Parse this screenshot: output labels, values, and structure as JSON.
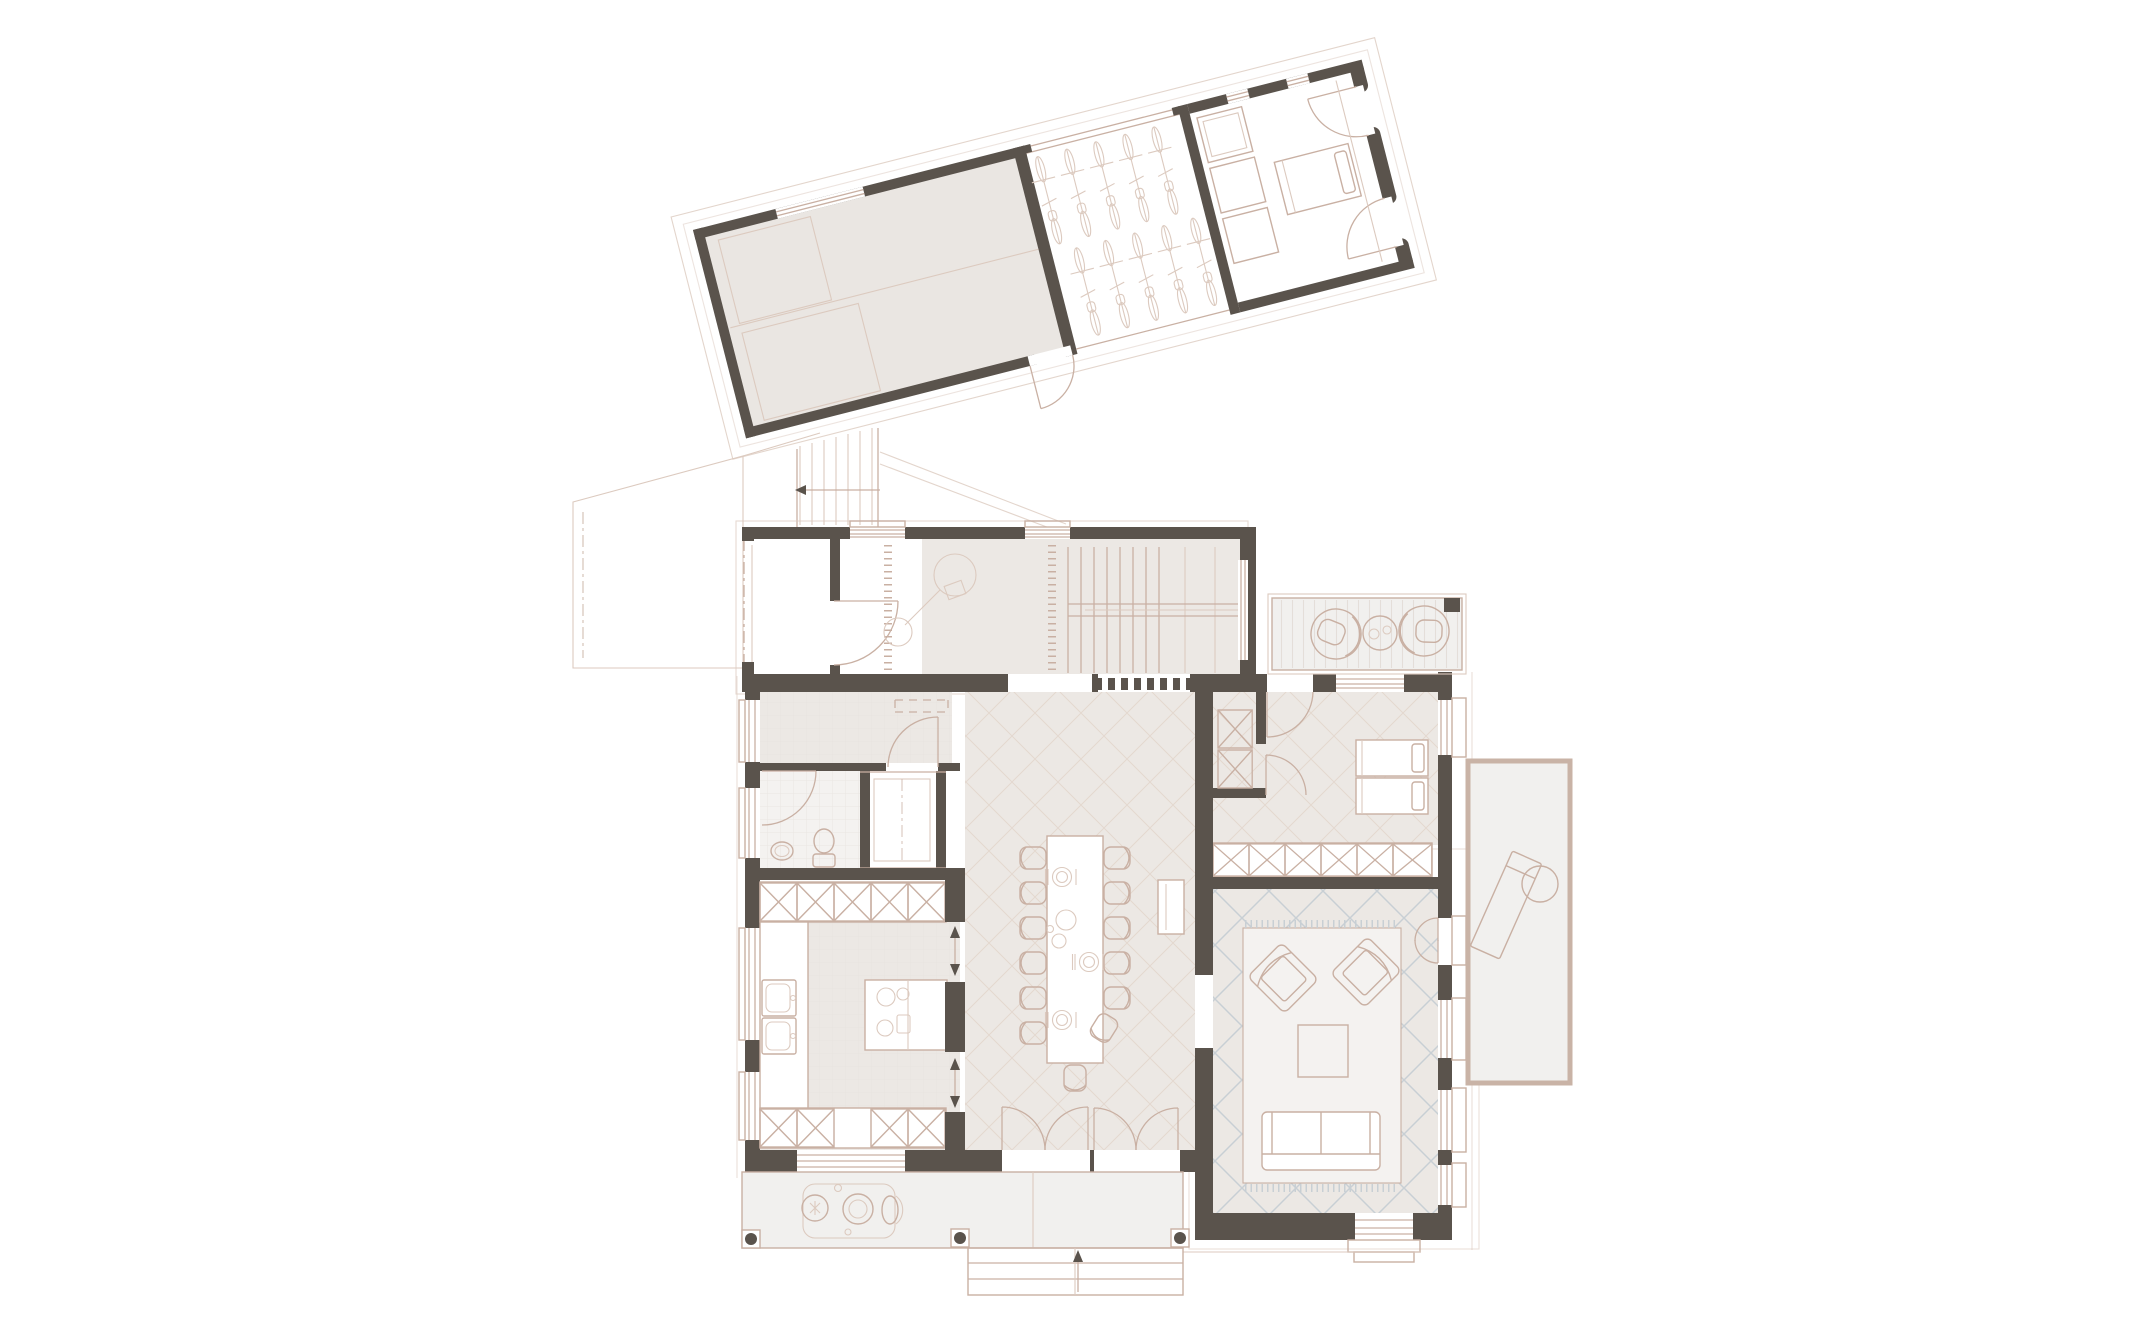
{
  "meta": {
    "description": "Ground floor architectural plan: main house with entry hall, staircase, storage, bathroom, kitchen, dining hall, guest room and living room; rotated annex with garage, bike shelter and garden room; exterior connecting stair, carport outline, northeast deck, east terrace, south veranda with steps."
  },
  "palette": {
    "background": "#ffffff",
    "wall": "#5a534c",
    "wall-mid": "#8d857d",
    "line": "#c9b0a3",
    "line-faint": "#dccabf",
    "room-fill": "#ece8e4",
    "room-light": "#f4f2f0",
    "garage-fill": "#eae6e2",
    "terrace-fill": "#f1f0ee",
    "terrace-border": "#c9b3a6",
    "hatch-blue": "#c8cfd4",
    "hatch-pink": "#ddcdc2",
    "tile-line": "#e4ded9",
    "furniture-fill": "#ffffff"
  },
  "annex": {
    "rotation_deg": -14.3,
    "rooms": [
      {
        "name": "garage",
        "furniture": [
          "two marked parking bays",
          "outward double swing door"
        ]
      },
      {
        "name": "bike-shelter",
        "furniture": [
          "ten bicycles in two staggered rows"
        ]
      },
      {
        "name": "garden-room",
        "furniture": [
          "three storage shelves",
          "single bed",
          "two glazed doors",
          "rounded end walls"
        ]
      }
    ]
  },
  "main_house": {
    "rooms": [
      {
        "name": "entry-porch",
        "details": "open covered porch, dash-dot boundary"
      },
      {
        "name": "entry-hall",
        "furniture": [
          "entry door swing",
          "coat rack ticks",
          "lamp symbol"
        ]
      },
      {
        "name": "staircase",
        "details": "straight flight with handrail and direction arrow"
      },
      {
        "name": "storage-room",
        "furniture": [
          "dashed wardrobe",
          "door swing"
        ]
      },
      {
        "name": "bathroom",
        "furniture": [
          "wash basin",
          "toilet",
          "door swing"
        ]
      },
      {
        "name": "technical-shaft",
        "details": "white shaft between bathroom and kitchen"
      },
      {
        "name": "kitchen",
        "furniture": [
          "tall cabinet row",
          "double sink",
          "cooking island with hob",
          "base cabinet row",
          "two sliding openings to dining"
        ]
      },
      {
        "name": "dining-hall",
        "furniture": [
          "long table",
          "twelve side chairs",
          "head chair",
          "angled chair",
          "place settings",
          "radiator console",
          "double entry door",
          "two french doors to veranda"
        ]
      },
      {
        "name": "guest-room",
        "furniture": [
          "two single beds with pillows",
          "closet boxes",
          "wardrobe row",
          "two door swings"
        ]
      },
      {
        "name": "living-room",
        "furniture": [
          "rug with fringe",
          "two angled armchairs",
          "square coffee table",
          "sofa",
          "terrace door",
          "sliding garden door"
        ]
      }
    ]
  },
  "outdoor": {
    "elements": [
      {
        "name": "exterior-stair",
        "details": "flight from annex to entry porch with walk-line arrow"
      },
      {
        "name": "carport-outline",
        "details": "faint polygon west of entry"
      },
      {
        "name": "northeast-deck",
        "furniture": [
          "two round lounge chairs",
          "round side table",
          "plank decking"
        ]
      },
      {
        "name": "east-terrace",
        "furniture": [
          "sun lounger",
          "round table"
        ]
      },
      {
        "name": "south-veranda",
        "furniture": [
          "bistro table set",
          "three posts"
        ]
      },
      {
        "name": "veranda-steps",
        "details": "three treads with up arrow"
      },
      {
        "name": "living-room-steps",
        "details": "two treads below sliding door"
      }
    ]
  }
}
